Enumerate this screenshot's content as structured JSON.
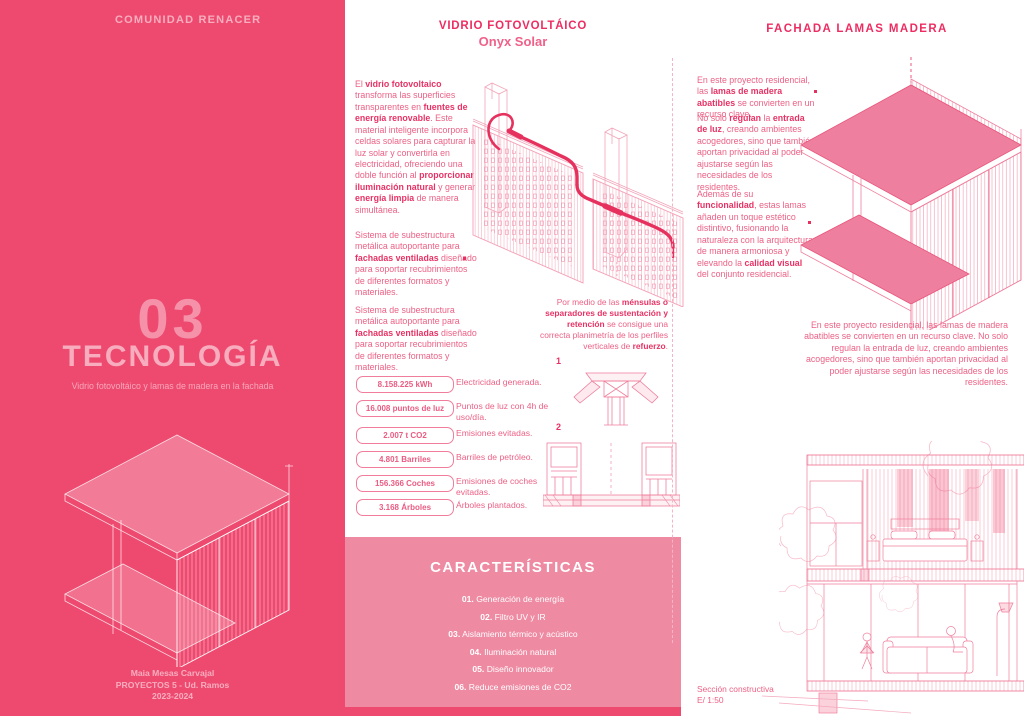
{
  "colors": {
    "panel_pink": "#ee4a70",
    "features_box_pink": "#ee8aa2",
    "heading_pink": "#ed2d62",
    "body_text_pink": "#ec6186",
    "drawing_line_light": "#f3a9bd",
    "drawing_line_medium": "#ef7f9d",
    "cable_accent": "#e6315e",
    "background": "#ffffff"
  },
  "left_panel": {
    "header": "COMUNIDAD RENACER",
    "number": "03",
    "title": "TECNOLOGÍA",
    "subtitle": "Vidrio fotovoltáico y lamas de madera en la fachada",
    "credits": [
      "Maia Mesas Carvajal",
      "PROYECTOS 5 - Ud. Ramos",
      "2023-2024"
    ]
  },
  "middle": {
    "title": "VIDRIO FOTOVOLTÁICO",
    "subtitle": "Onyx Solar",
    "paragraphs": [
      "El **vidrio fotovoltaico** transforma las superficies transparentes en **fuentes de energía renovable**. Este material inteligente incorpora celdas solares para capturar la luz solar y convertirla en electricidad, ofreciendo una doble función al **proporcionar iluminación natural** y generar **energía limpia** de manera simultánea.",
      "Sistema de subestructura metálica autoportante para **fachadas ventiladas** diseñado para soportar recubrimientos de diferentes formatos y materiales.",
      "Sistema de subestructura metálica autoportante para **fachadas ventiladas** diseñado para soportar recubrimientos de diferentes formatos y materiales."
    ],
    "caption": "Por medio de las **ménsulas o separadores de sustentación y retención** se consigue una correcta planimetría de los perfiles verticales de **refuerzo**.",
    "details": [
      {
        "label": "1"
      },
      {
        "label": "2"
      }
    ],
    "stats": [
      {
        "value": "8.158.225 kWh",
        "desc": "Electricidad generada."
      },
      {
        "value": "16.008 puntos de luz",
        "desc": "Puntos de luz con 4h de uso/día."
      },
      {
        "value": "2.007 t CO2",
        "desc": "Emisiones evitadas."
      },
      {
        "value": "4.801 Barriles",
        "desc": "Barriles de petróleo."
      },
      {
        "value": "156.366 Coches",
        "desc": "Emisiones de coches evitadas."
      },
      {
        "value": "3.168 Árboles",
        "desc": "Árboles plantados."
      }
    ],
    "features": {
      "title": "CARACTERÍSTICAS",
      "items": [
        "**01.** Generación de energía",
        "**02.** Filtro UV y IR",
        "**03.** Aislamiento térmico y acústico",
        "**04.** Iluminación natural",
        "**05.** Diseño innovador",
        "**06.** Reduce emisiones de CO2"
      ]
    }
  },
  "right": {
    "title": "FACHADA LAMAS MADERA",
    "paragraphs": [
      "En este proyecto residencial, las **lamas de madera abatibles** se convierten en un recurso clave.",
      "No solo **regulan** la **entrada de luz**, creando ambientes acogedores, sino que también aportan privacidad al poder ajustarse según las necesidades de los residentes.",
      "Además de su **funcionalidad**, estas lamas añaden un toque estético distintivo, fusionando la naturaleza con la arquitectura de manera armoniosa y elevando la **calidad visual** del conjunto residencial."
    ],
    "summary": "En este proyecto residencial, las lamas de madera abatibles se convierten en un recurso clave. No solo regulan la entrada de luz, creando ambientes acogedores, sino que también aportan privacidad al poder ajustarse según las necesidades de los residentes.",
    "section_caption": {
      "line1": "Sección constructiva",
      "line2": "E/ 1:50"
    }
  }
}
